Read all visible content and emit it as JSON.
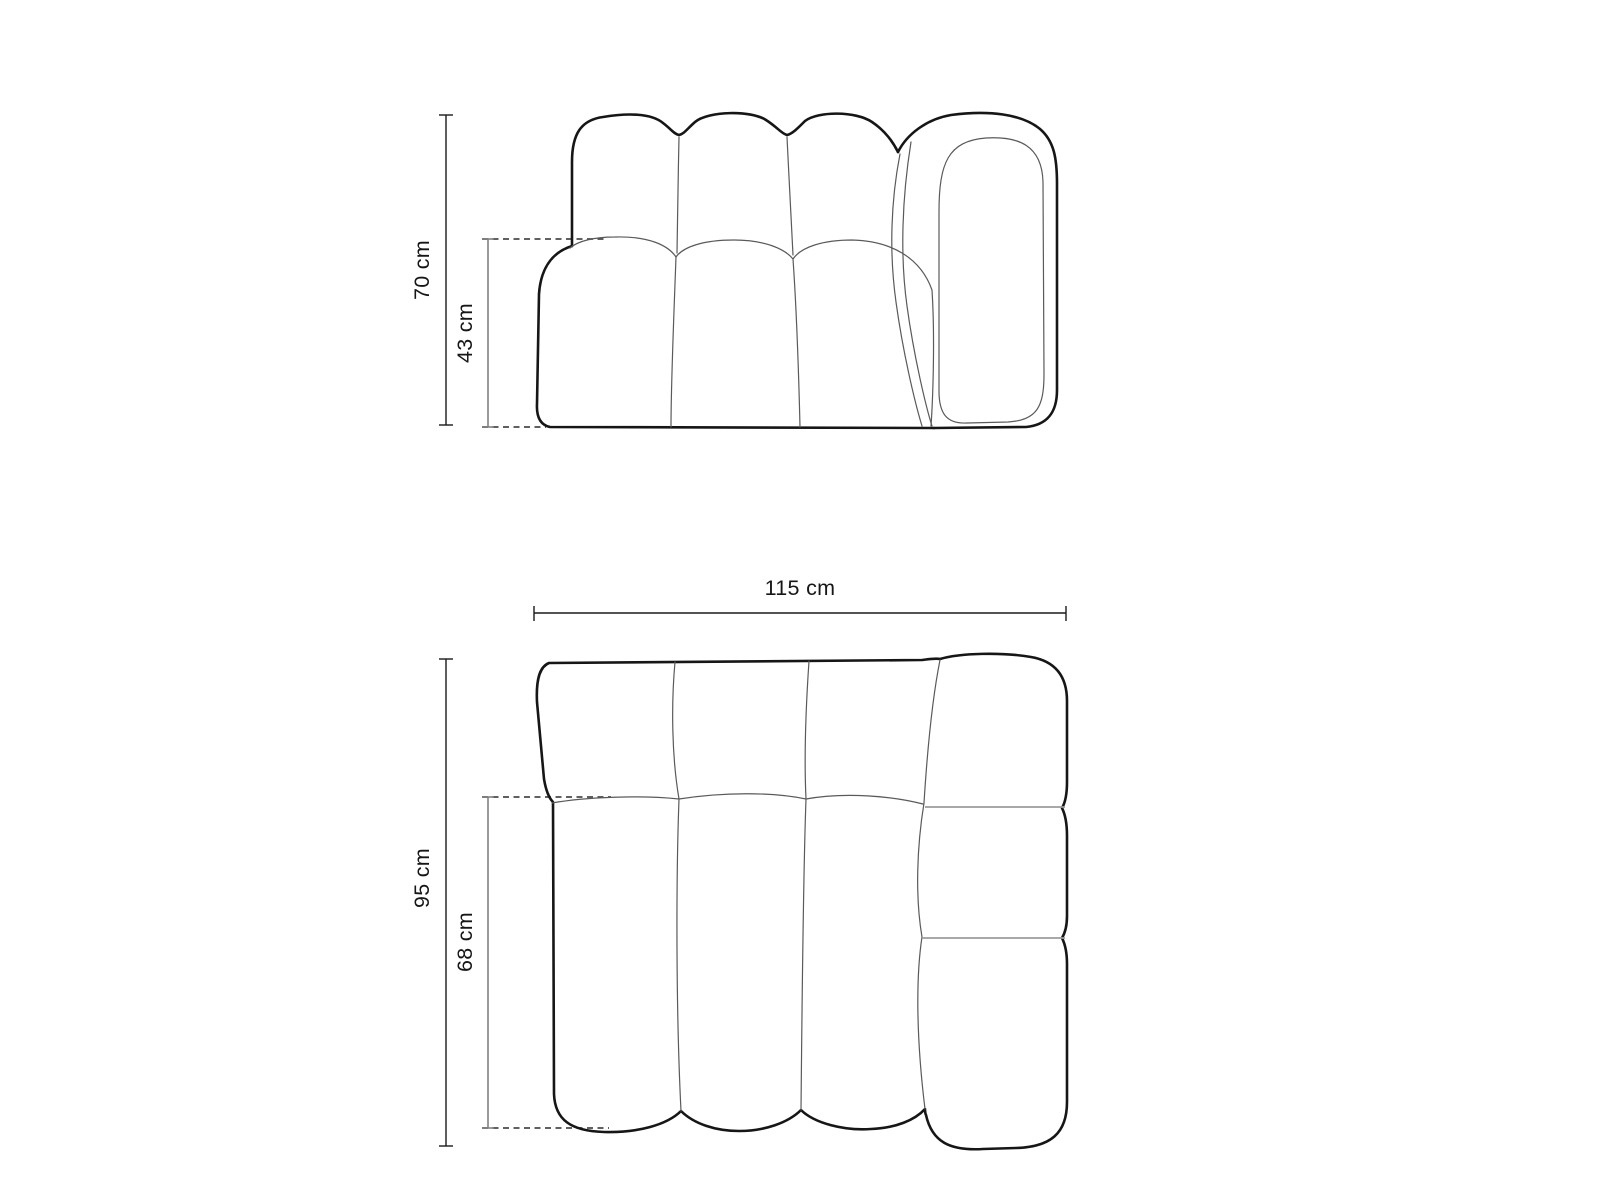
{
  "drawing": {
    "front_view": {
      "dimensions": {
        "total_height": "70 cm",
        "seat_height": "43 cm"
      }
    },
    "top_view": {
      "dimensions": {
        "total_width": "115 cm",
        "total_depth": "95 cm",
        "seat_depth": "68 cm"
      }
    },
    "colors": {
      "outline": "#161616",
      "seam_line": "#5a5a5a",
      "panel_divider": "#9c9c9c",
      "dimension_primary": "#1a1a1a",
      "dimension_secondary": "#808080",
      "dashed_guide": "#4a4a4a",
      "background": "#ffffff"
    }
  }
}
